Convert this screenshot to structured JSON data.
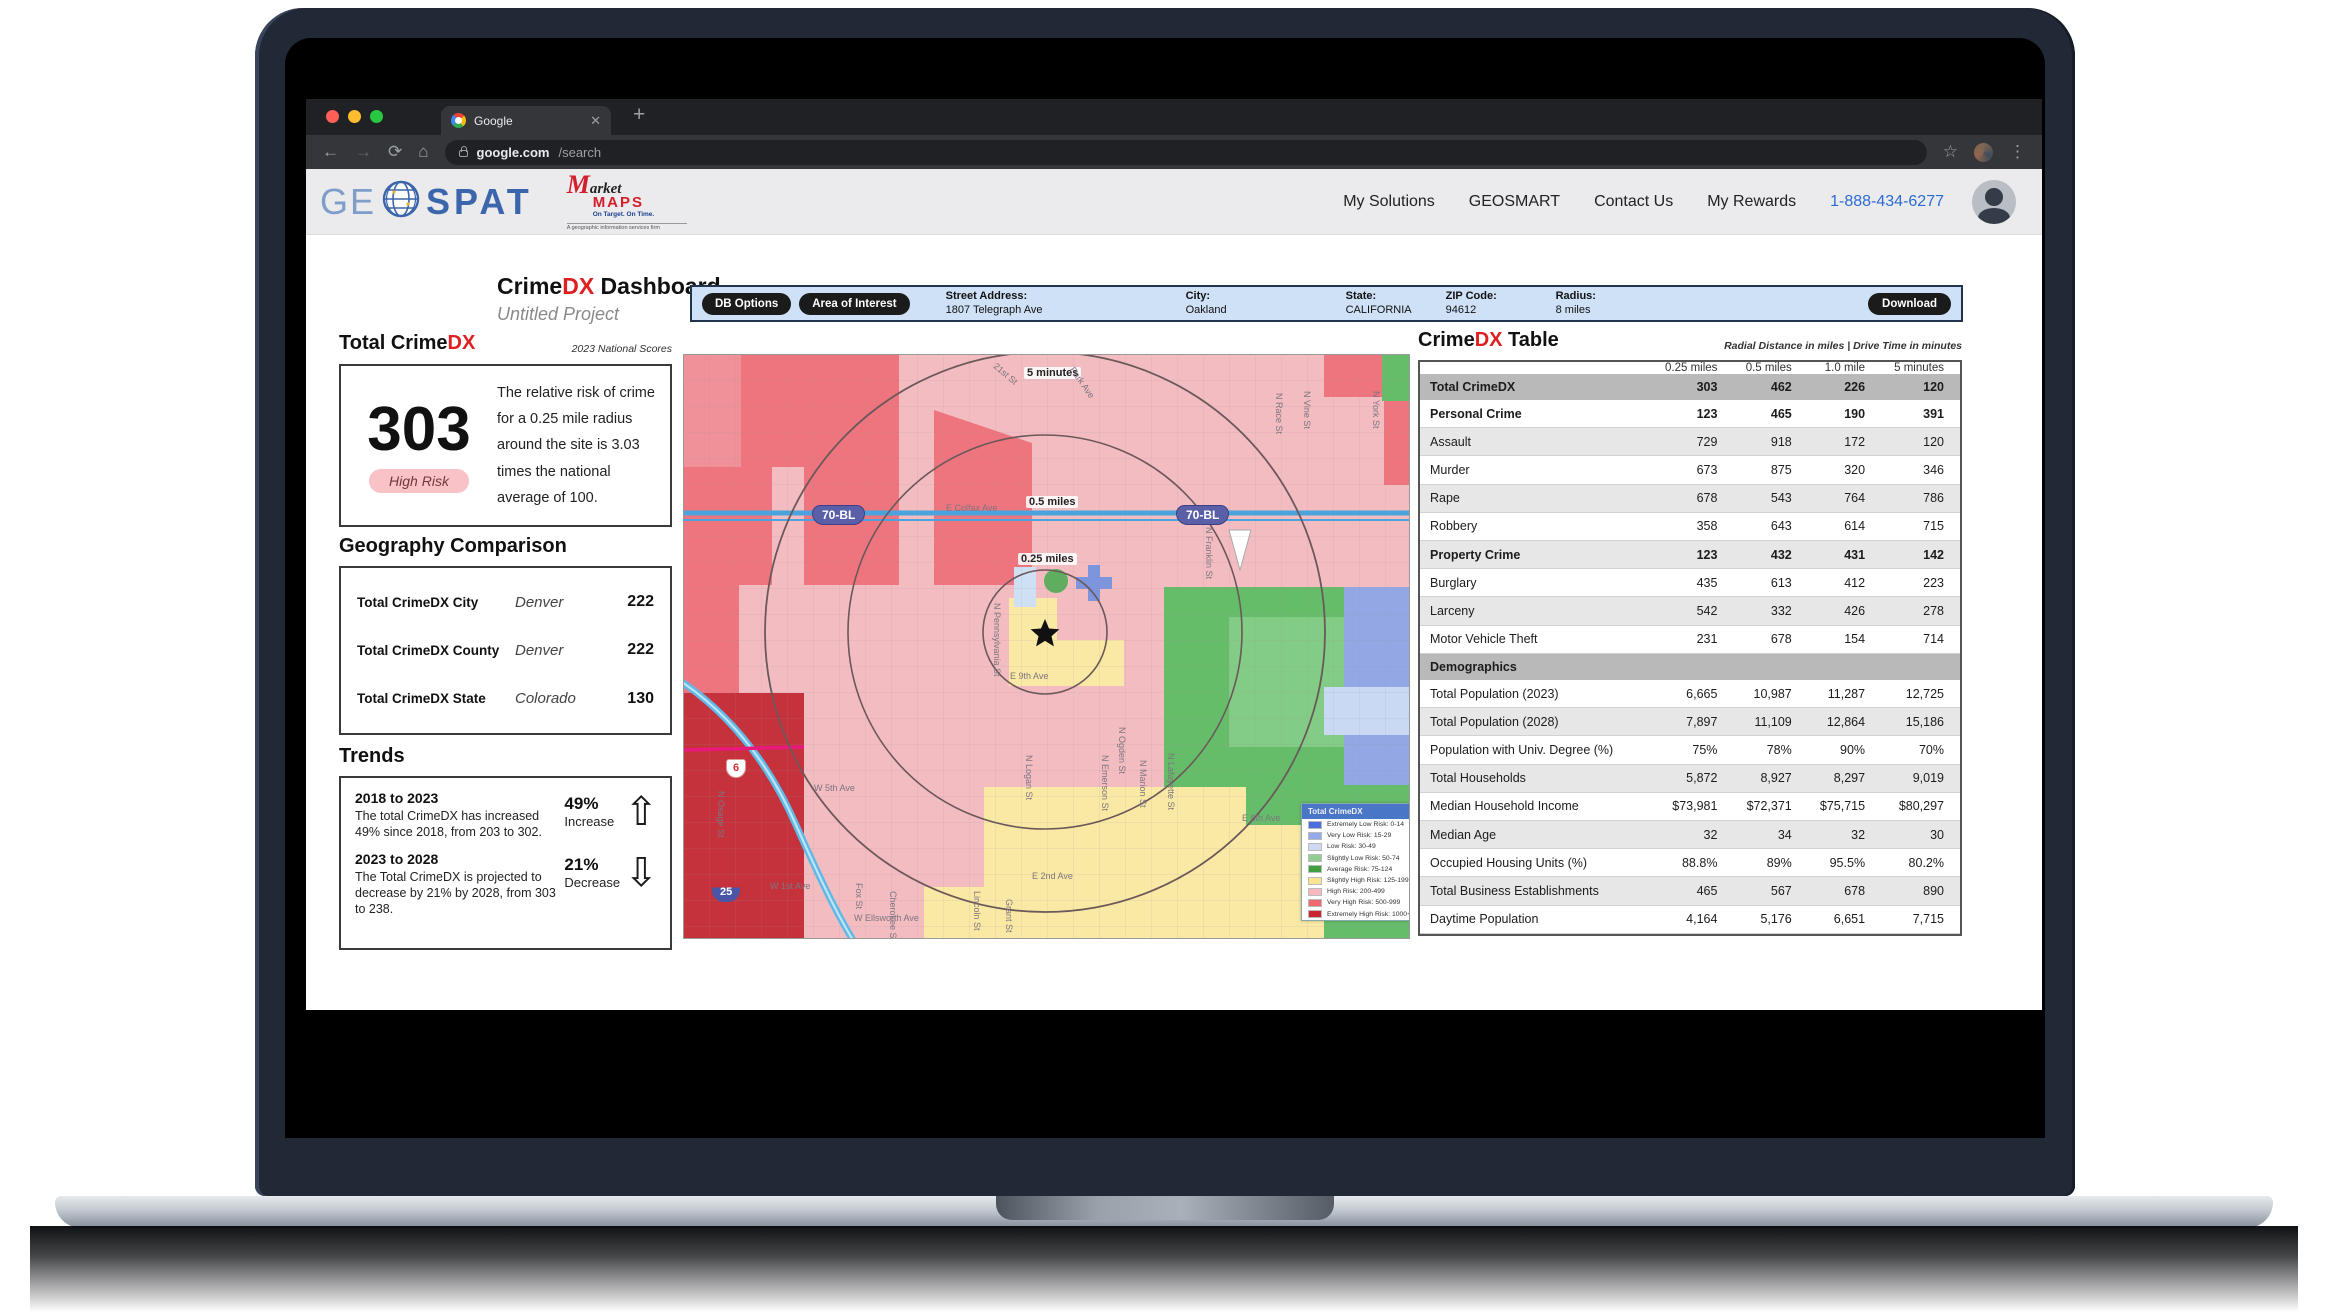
{
  "browser": {
    "tab_title": "Google",
    "url_host": "google.com",
    "url_path": "/search"
  },
  "header": {
    "logo": {
      "ge": "GE",
      "spat": "SPAT"
    },
    "marketmaps": {
      "m": "M",
      "arket": "arket",
      "maps": "MAPS",
      "tagline": "On Target.  On Time.",
      "sub": "A geographic information services firm"
    },
    "nav": [
      "My Solutions",
      "GEOSMART",
      "Contact Us",
      "My Rewards"
    ],
    "phone": "1-888-434-6277"
  },
  "dashboard": {
    "title_crime": "Crime",
    "title_dx": "DX",
    "title_rest": " Dashboard",
    "subtitle": "Untitled Project"
  },
  "toolbar": {
    "buttons": [
      "DB Options",
      "Area of Interest"
    ],
    "fields": [
      {
        "label": "Street Address:",
        "value": "1807 Telegraph Ave"
      },
      {
        "label": "City:",
        "value": "Oakland"
      },
      {
        "label": "State:",
        "value": "CALIFORNIA"
      },
      {
        "label": "ZIP Code:",
        "value": "94612"
      },
      {
        "label": "Radius:",
        "value": "8 miles"
      }
    ],
    "download": "Download"
  },
  "total": {
    "heading_black": "Total Crime",
    "heading_red": "DX",
    "note": "2023 National Scores",
    "score": "303",
    "badge": "High Risk",
    "desc": "The relative risk of crime for a 0.25 mile radius around the site is 3.03 times the national average of 100."
  },
  "geography": {
    "heading": "Geography Comparison",
    "rows": [
      {
        "label": "Total CrimeDX City",
        "place": "Denver",
        "value": "222"
      },
      {
        "label": "Total CrimeDX County",
        "place": "Denver",
        "value": "222"
      },
      {
        "label": "Total CrimeDX State",
        "place": "Colorado",
        "value": "130"
      }
    ]
  },
  "trends": {
    "heading": "Trends",
    "items": [
      {
        "period": "2018 to 2023",
        "text": "The total CrimeDX has increased 49% since 2018, from 203 to 302.",
        "pct": "49%",
        "dir": "Increase",
        "arrow": "up"
      },
      {
        "period": "2023 to 2028",
        "text": "The Total CrimeDX is projected to decrease by 21% by 2028, from 303 to 238.",
        "pct": "21%",
        "dir": "Decrease",
        "arrow": "down"
      }
    ]
  },
  "map": {
    "labels": [
      {
        "t": "5 minutes",
        "x": 340,
        "y": 12,
        "chip": true
      },
      {
        "t": "0.5 miles",
        "x": 342,
        "y": 141,
        "chip": true
      },
      {
        "t": "0.25 miles",
        "x": 334,
        "y": 198,
        "chip": true
      },
      {
        "t": "E Colfax Ave",
        "x": 262,
        "y": 148
      },
      {
        "t": "E 9th Ave",
        "x": 326,
        "y": 316
      },
      {
        "t": "E 2nd Ave",
        "x": 348,
        "y": 516
      },
      {
        "t": "E 8th Ave",
        "x": 558,
        "y": 458
      },
      {
        "t": "W 5th Ave",
        "x": 130,
        "y": 428
      },
      {
        "t": "W 1st Ave",
        "x": 86,
        "y": 526
      },
      {
        "t": "W Ellsworth Ave",
        "x": 170,
        "y": 558
      },
      {
        "t": "21st St",
        "x": 314,
        "y": 6,
        "rot": 40
      },
      {
        "t": "Park Ave",
        "x": 392,
        "y": 10,
        "rot": 55
      },
      {
        "t": "N Pennsylvania St",
        "x": 318,
        "y": 248,
        "rot": 90
      },
      {
        "t": "N Franklin St",
        "x": 530,
        "y": 172,
        "rot": 90
      },
      {
        "t": "N Ogden St",
        "x": 443,
        "y": 372,
        "rot": 90
      },
      {
        "t": "N Emerson St",
        "x": 426,
        "y": 400,
        "rot": 90
      },
      {
        "t": "N Marion St",
        "x": 464,
        "y": 405,
        "rot": 90
      },
      {
        "t": "N Lafayette St",
        "x": 492,
        "y": 398,
        "rot": 90
      },
      {
        "t": "N Race St",
        "x": 600,
        "y": 38,
        "rot": 90
      },
      {
        "t": "N Vine St",
        "x": 628,
        "y": 36,
        "rot": 90
      },
      {
        "t": "N York St",
        "x": 697,
        "y": 36,
        "rot": 90
      },
      {
        "t": "Fox St",
        "x": 180,
        "y": 528,
        "rot": 90
      },
      {
        "t": "Cherokee St",
        "x": 214,
        "y": 536,
        "rot": 90
      },
      {
        "t": "Lincoln St",
        "x": 298,
        "y": 536,
        "rot": 90
      },
      {
        "t": "Grant St",
        "x": 330,
        "y": 544,
        "rot": 90
      },
      {
        "t": "N Osage St",
        "x": 42,
        "y": 436,
        "rot": 90
      },
      {
        "t": "N Logan St",
        "x": 350,
        "y": 400,
        "rot": 90
      }
    ],
    "shields": [
      {
        "t": "70-BL",
        "x": 128,
        "y": 150,
        "type": "purple"
      },
      {
        "t": "70-BL",
        "x": 492,
        "y": 150,
        "type": "purple"
      },
      {
        "t": "25",
        "x": 28,
        "y": 528,
        "type": "interstate"
      },
      {
        "t": "6",
        "x": 42,
        "y": 404,
        "type": "us"
      }
    ],
    "legend": {
      "title": "Total CrimeDX",
      "items": [
        {
          "label": "Extremely Low Risk: 0-14",
          "color": "#4a6fdc"
        },
        {
          "label": "Very Low Risk: 15-29",
          "color": "#93a9ea"
        },
        {
          "label": "Low Risk: 30-49",
          "color": "#cdd8f4"
        },
        {
          "label": "Slightly Low Risk: 50-74",
          "color": "#8fce8f"
        },
        {
          "label": "Average Risk: 75-124",
          "color": "#3f9e3f"
        },
        {
          "label": "Slightly High Risk: 125-199",
          "color": "#fbe491"
        },
        {
          "label": "High Risk: 200-499",
          "color": "#f7b9be"
        },
        {
          "label": "Very High Risk: 500-999",
          "color": "#ee6a70"
        },
        {
          "label": "Extremely High Risk: 1000+",
          "color": "#c9262e"
        }
      ]
    }
  },
  "table": {
    "heading_black": "Crime",
    "heading_red": "DX",
    "heading_rest": " Table",
    "note": "Radial Distance in miles | Drive Time in minutes",
    "columns": [
      "0.25 miles",
      "0.5 miles",
      "1.0 mile",
      "5 minutes"
    ],
    "rows": [
      {
        "label": "Total CrimeDX",
        "values": [
          "303",
          "462",
          "226",
          "120"
        ],
        "kind": "section"
      },
      {
        "label": "Personal Crime",
        "values": [
          "123",
          "465",
          "190",
          "391"
        ],
        "kind": "group"
      },
      {
        "label": "Assault",
        "values": [
          "729",
          "918",
          "172",
          "120"
        ],
        "kind": "sub",
        "shade": true
      },
      {
        "label": "Murder",
        "values": [
          "673",
          "875",
          "320",
          "346"
        ],
        "kind": "sub"
      },
      {
        "label": "Rape",
        "values": [
          "678",
          "543",
          "764",
          "786"
        ],
        "kind": "sub",
        "shade": true
      },
      {
        "label": "Robbery",
        "values": [
          "358",
          "643",
          "614",
          "715"
        ],
        "kind": "sub"
      },
      {
        "label": "Property Crime",
        "values": [
          "123",
          "432",
          "431",
          "142"
        ],
        "kind": "group",
        "shade": true
      },
      {
        "label": "Burglary",
        "values": [
          "435",
          "613",
          "412",
          "223"
        ],
        "kind": "sub"
      },
      {
        "label": "Larceny",
        "values": [
          "542",
          "332",
          "426",
          "278"
        ],
        "kind": "sub",
        "shade": true
      },
      {
        "label": "Motor Vehicle Theft",
        "values": [
          "231",
          "678",
          "154",
          "714"
        ],
        "kind": "sub"
      },
      {
        "label": "Demographics",
        "values": [
          "",
          "",
          "",
          ""
        ],
        "kind": "section"
      },
      {
        "label": "Total Population (2023)",
        "values": [
          "6,665",
          "10,987",
          "11,287",
          "12,725"
        ],
        "kind": "demo"
      },
      {
        "label": "Total Population (2028)",
        "values": [
          "7,897",
          "11,109",
          "12,864",
          "15,186"
        ],
        "kind": "demo",
        "shade": true
      },
      {
        "label": "Population with Univ. Degree (%)",
        "values": [
          "75%",
          "78%",
          "90%",
          "70%"
        ],
        "kind": "demo"
      },
      {
        "label": "Total Households",
        "values": [
          "5,872",
          "8,927",
          "8,297",
          "9,019"
        ],
        "kind": "demo",
        "shade": true
      },
      {
        "label": "Median Household Income",
        "values": [
          "$73,981",
          "$72,371",
          "$75,715",
          "$80,297"
        ],
        "kind": "demo"
      },
      {
        "label": "Median Age",
        "values": [
          "32",
          "34",
          "32",
          "30"
        ],
        "kind": "demo",
        "shade": true
      },
      {
        "label": "Occupied Housing Units (%)",
        "values": [
          "88.8%",
          "89%",
          "95.5%",
          "80.2%"
        ],
        "kind": "demo"
      },
      {
        "label": "Total Business Establishments",
        "values": [
          "465",
          "567",
          "678",
          "890"
        ],
        "kind": "demo",
        "shade": true
      },
      {
        "label": "Daytime Population",
        "values": [
          "4,164",
          "5,176",
          "6,651",
          "7,715"
        ],
        "kind": "demo"
      }
    ]
  }
}
